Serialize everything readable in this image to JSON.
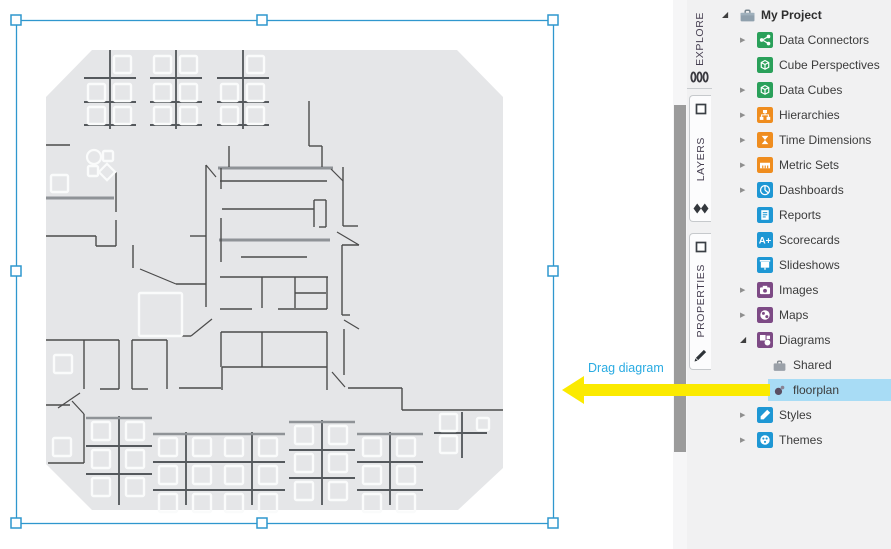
{
  "annotation": {
    "label": "Drag diagram",
    "label_color": "#29abe2",
    "arrow_color": "#fbea00"
  },
  "toolbar_tabs": [
    {
      "label": "EXPLORE",
      "active": true,
      "icons": [
        "database-icon"
      ]
    },
    {
      "label": "LAYERS",
      "active": false,
      "icons": [
        "panel-square-icon",
        "layers-diamonds-icon"
      ]
    },
    {
      "label": "PROPERTIES",
      "active": false,
      "icons": [
        "panel-square-icon",
        "pencil-icon"
      ]
    }
  ],
  "project_tree": {
    "items": [
      {
        "label": "My Project",
        "icon": "briefcase",
        "color": "#8fa0ad",
        "expander": "expanded",
        "level": 0,
        "selected": false
      },
      {
        "label": "Data Connectors",
        "icon": "connectors",
        "color": "#2aa05a",
        "expander": "collapsed",
        "level": 1,
        "selected": false
      },
      {
        "label": "Cube Perspectives",
        "icon": "cube",
        "color": "#2aa05a",
        "expander": "none",
        "level": 1,
        "selected": false
      },
      {
        "label": "Data Cubes",
        "icon": "datacube",
        "color": "#2aa05a",
        "expander": "collapsed",
        "level": 1,
        "selected": false
      },
      {
        "label": "Hierarchies",
        "icon": "hierarchy",
        "color": "#ef8d1f",
        "expander": "collapsed",
        "level": 1,
        "selected": false
      },
      {
        "label": "Time Dimensions",
        "icon": "hourglass",
        "color": "#ef8d1f",
        "expander": "collapsed",
        "level": 1,
        "selected": false
      },
      {
        "label": "Metric Sets",
        "icon": "ruler",
        "color": "#ef8d1f",
        "expander": "collapsed",
        "level": 1,
        "selected": false
      },
      {
        "label": "Dashboards",
        "icon": "pie",
        "color": "#1e97d4",
        "expander": "collapsed",
        "level": 1,
        "selected": false
      },
      {
        "label": "Reports",
        "icon": "report",
        "color": "#1e97d4",
        "expander": "none",
        "level": 1,
        "selected": false
      },
      {
        "label": "Scorecards",
        "icon": "aplus",
        "color": "#1e97d4",
        "expander": "none",
        "level": 1,
        "selected": false
      },
      {
        "label": "Slideshows",
        "icon": "screen",
        "color": "#1e97d4",
        "expander": "none",
        "level": 1,
        "selected": false
      },
      {
        "label": "Images",
        "icon": "camera",
        "color": "#7d4a85",
        "expander": "collapsed",
        "level": 1,
        "selected": false
      },
      {
        "label": "Maps",
        "icon": "globe",
        "color": "#7d4a85",
        "expander": "collapsed",
        "level": 1,
        "selected": false
      },
      {
        "label": "Diagrams",
        "icon": "shapes",
        "color": "#7d4a85",
        "expander": "expanded",
        "level": 1,
        "selected": false
      },
      {
        "label": "Shared",
        "icon": "briefcase-small",
        "color": "#9aa0a8",
        "expander": "none",
        "level": 2,
        "selected": false
      },
      {
        "label": "floorplan",
        "icon": "diagram-dot",
        "color": "#5a4f63",
        "expander": "none",
        "level": 2,
        "selected": true
      },
      {
        "label": "Styles",
        "icon": "styles",
        "color": "#1e97d4",
        "expander": "collapsed",
        "level": 1,
        "selected": false
      },
      {
        "label": "Themes",
        "icon": "themes",
        "color": "#1e97d4",
        "expander": "collapsed",
        "level": 1,
        "selected": false
      }
    ],
    "selected_item_bg": "#a8dcf5"
  },
  "canvas": {
    "selection": {
      "color": "#2f97ce",
      "rect": [
        16,
        20,
        537,
        503
      ],
      "handles": [
        [
          16,
          20
        ],
        [
          262,
          20
        ],
        [
          553,
          20
        ],
        [
          16,
          271
        ],
        [
          553,
          271
        ],
        [
          16,
          523
        ],
        [
          262,
          523
        ],
        [
          553,
          523
        ]
      ]
    },
    "floorplan": {
      "background": "#e5e6e8",
      "wall_color": "#4b4b4b",
      "thick_wall_color": "#8f9397",
      "desk_color": "#fafbfb",
      "octagon": [
        [
          92,
          50
        ],
        [
          457,
          50
        ],
        [
          503,
          97
        ],
        [
          503,
          468
        ],
        [
          458,
          510
        ],
        [
          92,
          510
        ],
        [
          46,
          464
        ],
        [
          46,
          97
        ]
      ],
      "walls": [
        [
          309,
          101,
          309,
          146
        ],
        [
          309,
          146,
          322,
          146
        ],
        [
          322,
          146,
          322,
          167
        ],
        [
          229,
          146,
          229,
          167
        ],
        [
          220,
          181,
          327,
          181
        ],
        [
          221,
          168,
          221,
          189
        ],
        [
          222,
          209,
          314,
          209
        ],
        [
          314,
          200,
          314,
          227
        ],
        [
          326,
          200,
          326,
          227
        ],
        [
          314,
          200,
          326,
          200
        ],
        [
          319,
          227,
          326,
          227
        ],
        [
          221,
          218,
          221,
          262
        ],
        [
          241,
          257,
          307,
          257
        ],
        [
          220,
          277,
          328,
          277
        ],
        [
          262,
          277,
          262,
          308
        ],
        [
          295,
          277,
          295,
          308
        ],
        [
          327,
          277,
          327,
          309
        ],
        [
          295,
          293,
          326,
          293
        ],
        [
          220,
          309,
          252,
          309
        ],
        [
          278,
          309,
          327,
          309
        ],
        [
          206,
          165,
          206,
          307
        ],
        [
          190,
          236,
          206,
          236
        ],
        [
          176,
          284,
          206,
          284
        ],
        [
          133,
          245,
          133,
          268
        ],
        [
          343,
          167,
          343,
          226
        ],
        [
          343,
          226,
          358,
          226
        ],
        [
          342,
          245,
          342,
          315
        ],
        [
          342,
          245,
          359,
          245
        ],
        [
          342,
          315,
          350,
          315
        ],
        [
          344,
          329,
          344,
          375
        ],
        [
          348,
          388,
          402,
          388
        ],
        [
          402,
          388,
          402,
          410
        ],
        [
          402,
          410,
          503,
          410
        ],
        [
          221,
          332,
          327,
          332
        ],
        [
          221,
          332,
          221,
          367
        ],
        [
          262,
          332,
          262,
          367
        ],
        [
          327,
          332,
          327,
          390
        ],
        [
          222,
          367,
          327,
          367
        ],
        [
          222,
          367,
          222,
          390
        ],
        [
          179,
          388,
          221,
          388
        ],
        [
          177,
          336,
          191,
          336
        ],
        [
          46,
          145,
          70,
          145
        ],
        [
          116,
          172,
          116,
          212
        ],
        [
          46,
          236,
          96,
          236
        ],
        [
          96,
          236,
          96,
          246
        ],
        [
          96,
          246,
          116,
          246
        ],
        [
          116,
          220,
          116,
          246
        ],
        [
          46,
          340,
          119,
          340
        ],
        [
          84,
          340,
          84,
          389
        ],
        [
          119,
          340,
          119,
          389
        ],
        [
          100,
          389,
          119,
          389
        ],
        [
          46,
          405,
          70,
          405
        ],
        [
          132,
          340,
          132,
          389
        ],
        [
          167,
          340,
          167,
          389
        ],
        [
          132,
          340,
          167,
          340
        ],
        [
          132,
          389,
          148,
          389
        ],
        [
          84,
          414,
          84,
          463
        ],
        [
          48,
          463,
          84,
          463
        ]
      ],
      "diagonals": [
        [
          206,
          165,
          216,
          177
        ],
        [
          140,
          269,
          176,
          284
        ],
        [
          331,
          169,
          343,
          181
        ],
        [
          337,
          232,
          359,
          245
        ],
        [
          344,
          320,
          359,
          329
        ],
        [
          332,
          372,
          345,
          387
        ],
        [
          191,
          336,
          212,
          319
        ],
        [
          58,
          408,
          80,
          393
        ],
        [
          72,
          401,
          84,
          414
        ]
      ],
      "thick_walls": [
        [
          218,
          168,
          333,
          168
        ],
        [
          219,
          240,
          330,
          240
        ],
        [
          46,
          198,
          114,
          198
        ]
      ],
      "white_squares": [
        [
          51,
          175,
          17
        ],
        [
          139,
          293,
          43
        ],
        [
          54,
          355,
          18
        ],
        [
          53,
          438,
          18
        ],
        [
          103,
          151,
          10
        ],
        [
          88,
          166,
          10
        ]
      ],
      "white_circle": [
        94,
        157,
        7
      ],
      "white_diamond": [
        107,
        172,
        8
      ],
      "top_clusters": [
        {
          "cx": 110,
          "tl": false,
          "tr": true
        },
        {
          "cx": 176,
          "tl": true,
          "tr": true
        },
        {
          "cx": 243,
          "tl": false,
          "tr": true
        }
      ],
      "bottom_clusters": [
        {
          "cx": 119,
          "top": 416
        },
        {
          "cx": 186,
          "top": 432
        },
        {
          "cx": 252,
          "top": 432
        },
        {
          "cx": 322,
          "top": 420
        },
        {
          "cx": 390,
          "top": 432
        }
      ],
      "small_cluster": {
        "spine": [
          462,
          412,
          462,
          458
        ],
        "rung": [
          434,
          433,
          487,
          433
        ],
        "squares": [
          [
            440,
            414,
            17
          ],
          [
            440,
            436,
            17
          ],
          [
            477,
            418,
            12
          ]
        ]
      }
    }
  }
}
